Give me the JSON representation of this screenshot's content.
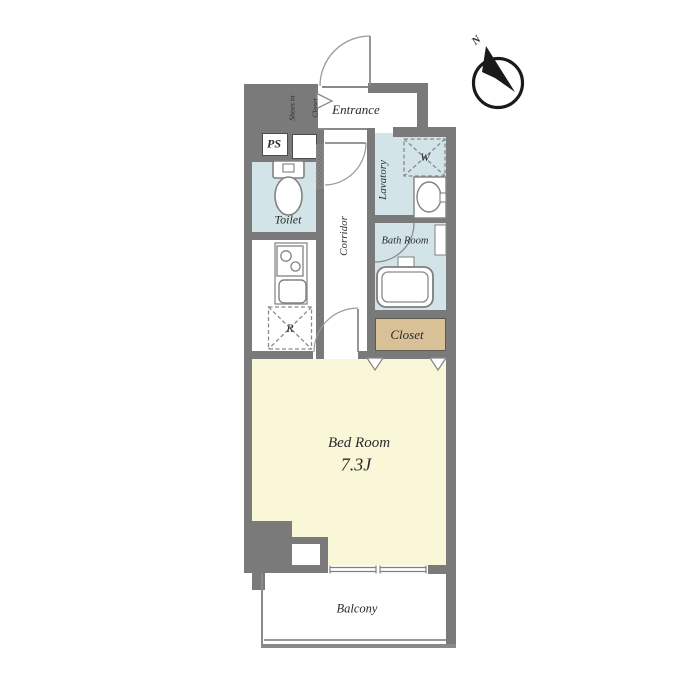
{
  "rooms": {
    "entrance": {
      "label": "Entrance"
    },
    "shoes_in_closet": {
      "line1": "Shoes in",
      "line2": "Closet"
    },
    "ps": {
      "label": "PS"
    },
    "toilet": {
      "label": "Toilet"
    },
    "corridor": {
      "label": "Corridor"
    },
    "lavatory": {
      "label": "Lavatory"
    },
    "washer_space": {
      "label": "W"
    },
    "bath_room": {
      "label": "Bath Room"
    },
    "closet": {
      "label": "Closet"
    },
    "fridge_space": {
      "label": "R"
    },
    "bed_room": {
      "label": "Bed Room",
      "size": "7.3J"
    },
    "balcony": {
      "label": "Balcony"
    }
  },
  "compass": {
    "north_label": "N"
  },
  "colors": {
    "wall": "#7a7a7a",
    "wet_area": "#d2e4e8",
    "storage": "#d9c197",
    "bedroom_floor": "#faf6d8",
    "fixture_line": "#858585",
    "text": "#2b2b2b"
  }
}
